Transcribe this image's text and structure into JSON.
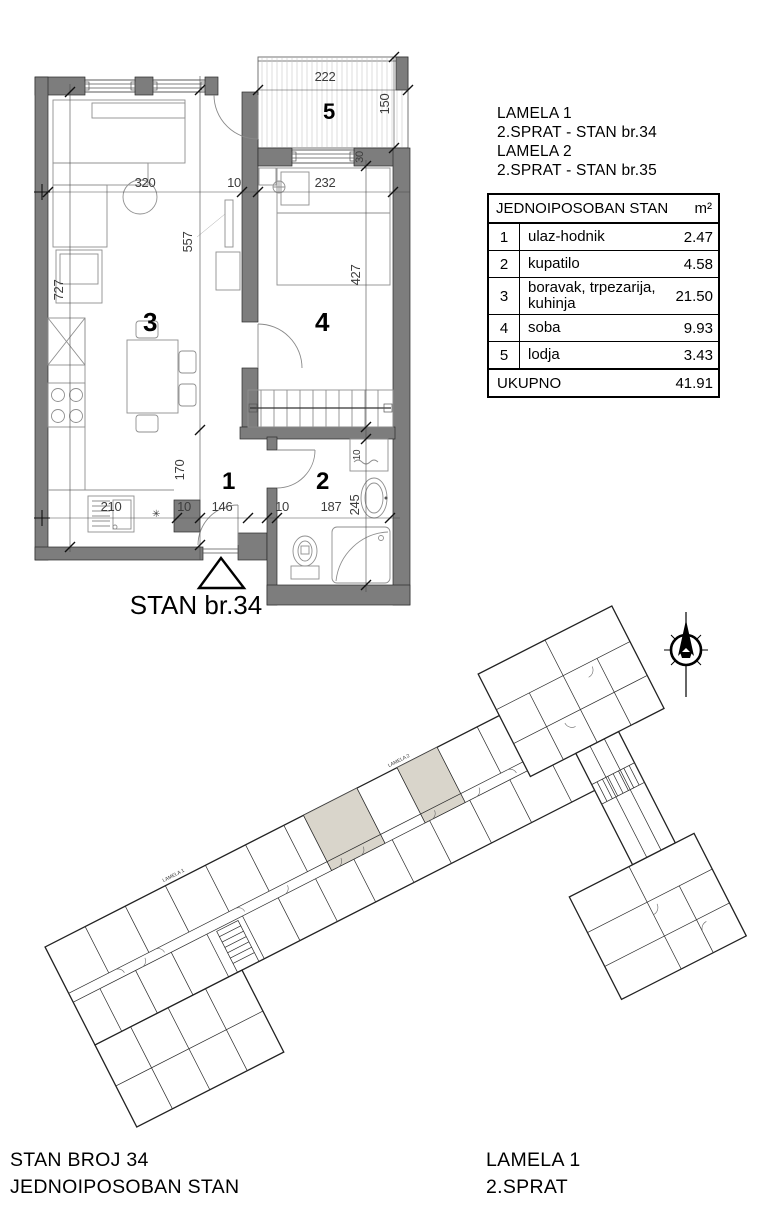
{
  "header_block": {
    "lines": [
      "LAMELA  1",
      "2.SPRAT   - STAN br.34",
      "LAMELA  2",
      "2.SPRAT   - STAN br.35"
    ]
  },
  "area_table": {
    "title": "JEDNOIPOSOBAN STAN",
    "unit": "m²",
    "rows": [
      {
        "num": "1",
        "name": "ulaz-hodnik",
        "area": "2.47"
      },
      {
        "num": "2",
        "name": "kupatilo",
        "area": "4.58"
      },
      {
        "num": "3",
        "name": "boravak, trpezarija, kuhinja",
        "area": "21.50"
      },
      {
        "num": "4",
        "name": "soba",
        "area": "9.93"
      },
      {
        "num": "5",
        "name": "lodja",
        "area": "3.43"
      }
    ],
    "total_label": "UKUPNO",
    "total_value": "41.91"
  },
  "floor_plan": {
    "entrance_label": "STAN br.34",
    "rooms": {
      "r1": "1",
      "r2": "2",
      "r3": "3",
      "r4": "4",
      "r5": "5"
    },
    "dims": {
      "lodja_w": "222",
      "lodja_h": "150",
      "wall": "30",
      "living_w": "320",
      "wall_a": "10",
      "bedroom_w": "232",
      "living_h": "557",
      "bedroom_h": "427",
      "left_h": "727",
      "hall_h": "170",
      "hall_wall": "10",
      "hall_w": "146",
      "bath_wall": "10",
      "bath_w": "187",
      "bath_h": "245",
      "kitchen_w": "210",
      "washer": "10"
    },
    "symbols": {
      "star": "✳"
    }
  },
  "site_plan": {
    "lamela1": "LAMELA 1",
    "lamela2": "LAMELA 2"
  },
  "footer": {
    "left_line1": "STAN BROJ 34",
    "left_line2": "JEDNOIPOSOBAN STAN",
    "right_line1": "LAMELA  1",
    "right_line2": "2.SPRAT"
  },
  "colors": {
    "wall": "#7d7d7d",
    "highlight": "#d9d5cb",
    "line": "#1e1e1e",
    "dim_text": "#3c3c3c"
  }
}
